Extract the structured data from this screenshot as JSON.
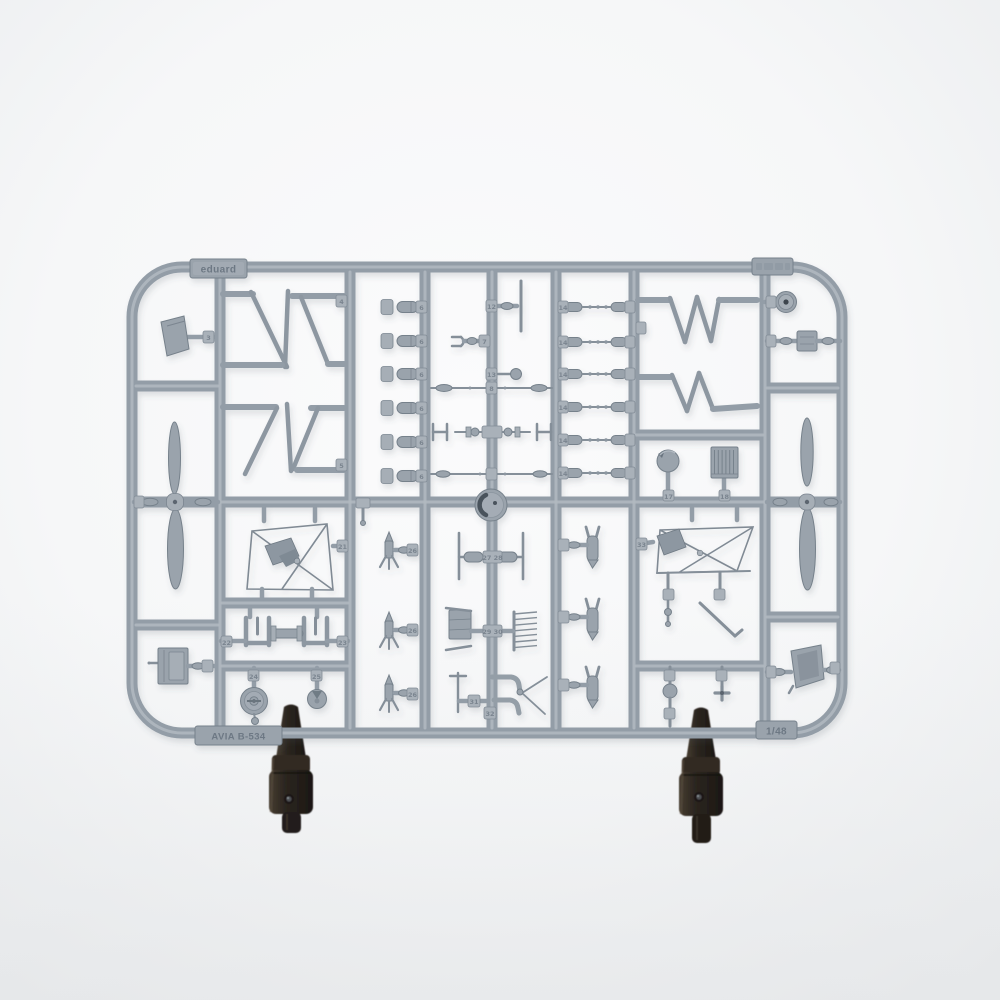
{
  "photo": {
    "type": "product photograph",
    "subject": "Injection-moulded grey plastic model-kit sprue (parts frame) on a white seamless background, held upright by two dark clamp stands",
    "background_color": "#f6f7f8",
    "plastic_color": "#9aa3ac",
    "plastic_highlight": "#b7bec5",
    "plastic_shadow": "#76818b",
    "clamp_color": "#2a241e"
  },
  "sprue": {
    "labels": {
      "brand": "eduard",
      "kit": "AVIA B-534",
      "scale": "1/48",
      "corner_code": ""
    },
    "part_numbers": {
      "windscreen": "3",
      "strut_top": "4",
      "strut_bottom": "5",
      "bomb": "6",
      "fork": "7",
      "rod_upper": "8",
      "t_rod": "12",
      "lever": "13",
      "gun_rod": "14",
      "ball": "17",
      "radiator": "18",
      "jig_left": "21",
      "u_left": "22",
      "u_right": "23",
      "wheel": "24",
      "hub_disc": "25",
      "rocket": "26",
      "axle": "27 28",
      "engine": "29 30",
      "pipe_upper": "31",
      "pipe_lower": "32",
      "jig_right": "33"
    },
    "contents": [
      {
        "part": "two-blade propeller",
        "qty": 2
      },
      {
        "part": "interplane N-strut pair",
        "qty": 4
      },
      {
        "part": "small bomb with carrier plate",
        "qty": 6
      },
      {
        "part": "machine-gun / rigging rod",
        "qty": 6
      },
      {
        "part": "finned rocket",
        "qty": 3
      },
      {
        "part": "finned bomb",
        "qty": 3
      },
      {
        "part": "windscreen",
        "qty": 1
      },
      {
        "part": "fuselage door",
        "qty": 1
      },
      {
        "part": "spoked main wheel",
        "qty": 1
      },
      {
        "part": "wheel hub disc",
        "qty": 1
      },
      {
        "part": "cowl ring disc",
        "qty": 2
      },
      {
        "part": "gun ball",
        "qty": 1
      },
      {
        "part": "radiator block",
        "qty": 1
      },
      {
        "part": "bucket seat",
        "qty": 1
      },
      {
        "part": "strut sub-assembly moulded in jig frame",
        "qty": 2
      },
      {
        "part": "axle with end struts",
        "qty": 1
      },
      {
        "part": "engine block and pushrod comb",
        "qty": 1
      },
      {
        "part": "exhaust elbow pipe",
        "qty": 2
      },
      {
        "part": "control rods, levers and linkages",
        "qty": 8
      }
    ]
  },
  "clamps": {
    "qty": 2,
    "description": "dark spring-clamp stands gripping the lower frame rail"
  }
}
